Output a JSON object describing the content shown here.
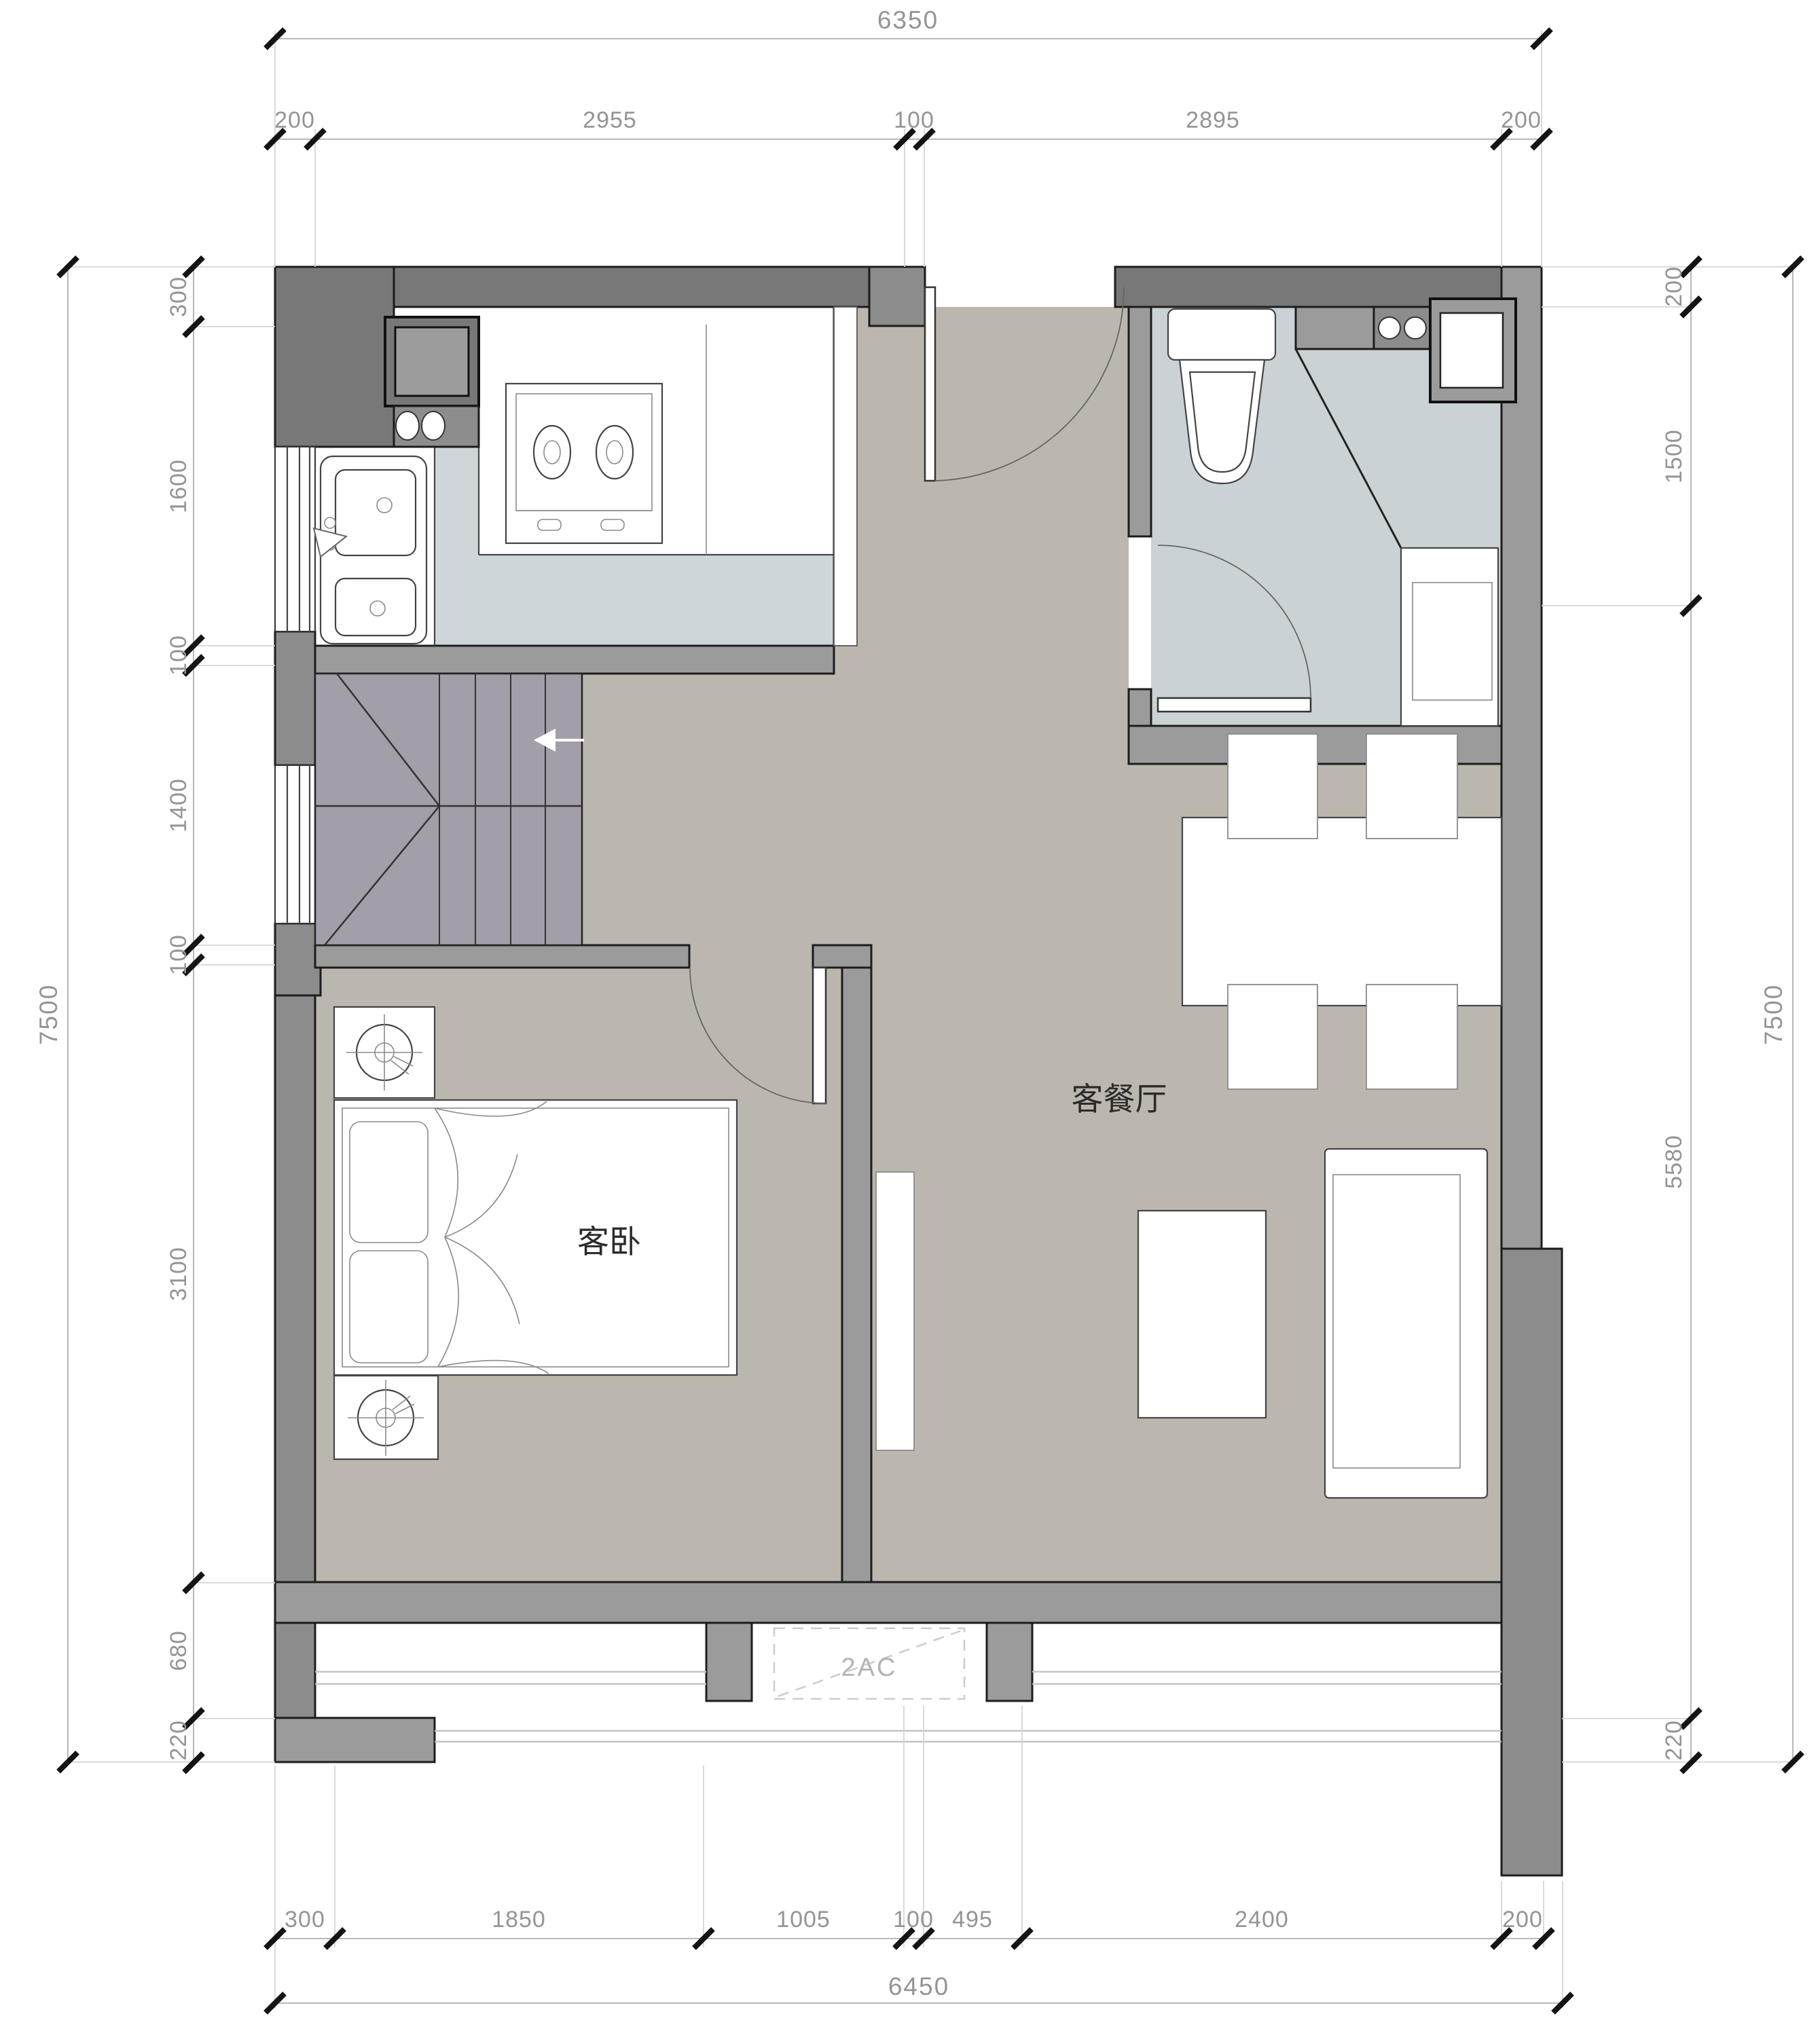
{
  "plan": {
    "rooms": {
      "living_dining": "客餐厅",
      "guest_bedroom": "客卧"
    },
    "annotations": {
      "ac_unit": "2AC"
    }
  },
  "dims": {
    "top": {
      "total": "6350",
      "segments": [
        "200",
        "2955",
        "100",
        "2895",
        "200"
      ]
    },
    "bottom": {
      "total": "6450",
      "segments": [
        "300",
        "1850",
        "1005",
        "100",
        "495",
        "2400",
        "200"
      ]
    },
    "left": {
      "total": "7500",
      "segments": [
        "300",
        "1600",
        "100",
        "1400",
        "100",
        "3100",
        "680",
        "220"
      ]
    },
    "right": {
      "total": "7500",
      "segments": [
        "200",
        "1500",
        "5580",
        "220"
      ]
    }
  },
  "colors": {
    "wall_dark": "#787878",
    "wall_mid": "#9b9b9b",
    "floor_kitchen": "#cfd6da",
    "floor_bath": "#cbd2d6",
    "floor_living": "#bcb7ae",
    "stair": "#a39ea7",
    "dim_text": "#949494"
  }
}
